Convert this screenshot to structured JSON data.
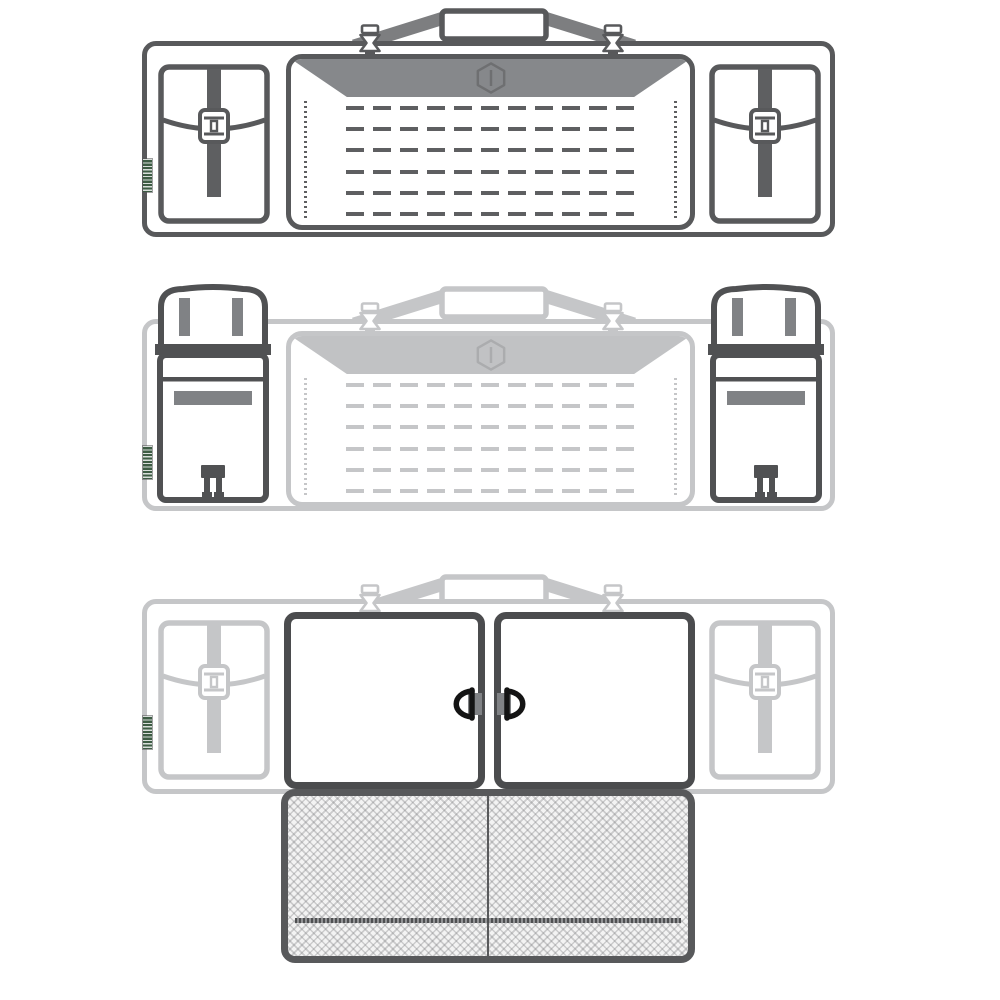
{
  "diagram": {
    "subject": "Tactical rifle case illustrated in three configurations",
    "views": [
      {
        "id": "view-1",
        "state": "case closed, front with MOLLE panel and two buckled side pouches"
      },
      {
        "id": "view-2",
        "state": "side pouches open with flaps raised, elastic loops and release buckles shown"
      },
      {
        "id": "view-3",
        "state": "main compartment doors open with D-ring pulls and lower mesh pocket extended"
      }
    ],
    "icons": [
      "brand-hexagon-logo",
      "side-release-buckle",
      "d-ring-pull",
      "zipper-track",
      "molle-webbing"
    ]
  },
  "colors": {
    "outline_dark": "#58595B",
    "mid_gray": "#808285",
    "strap_gray": "#7D7E80",
    "faded_gray": "#C5C6C8",
    "faded_fill": "#C1C2C4",
    "faded_logo": "#ABACAE",
    "ring_black": "#141414",
    "label_green": "#3D5C44",
    "mesh_base": "#F3F3F3",
    "door_line": "#4B4C4E",
    "white": "#FFFFFF"
  },
  "molle": {
    "rows": 6,
    "dash_px": 18,
    "gap_px": 9,
    "row_height_px": 4,
    "area_height_px": 110
  }
}
